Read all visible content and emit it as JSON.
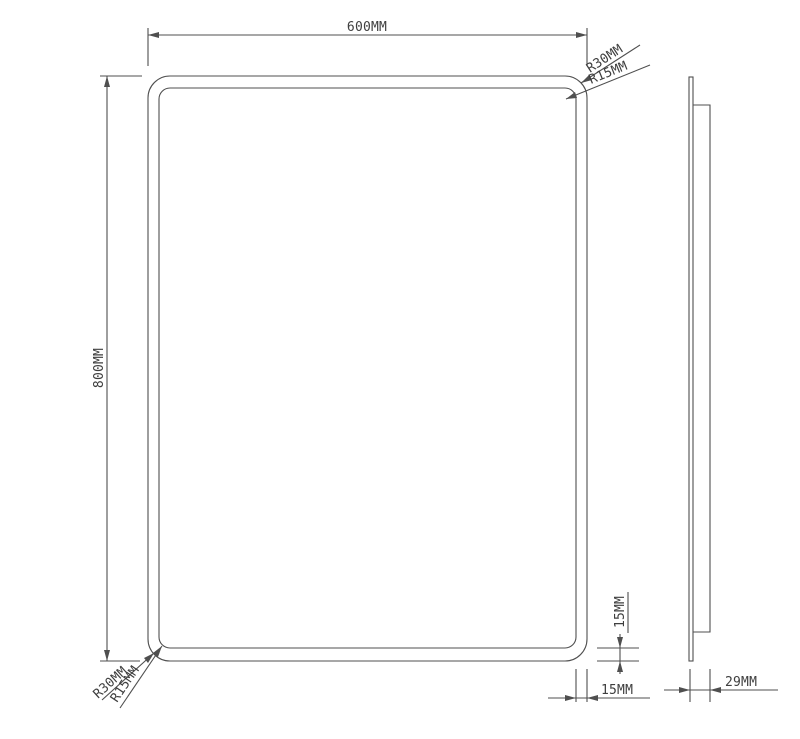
{
  "drawing": {
    "type": "technical-drawing",
    "subject": "rounded-rectangle mirror, front and side elevation",
    "colors": {
      "line": "#4f4f4f",
      "text": "#3e3e3e",
      "background": "#ffffff"
    },
    "front_view": {
      "width_label": "600MM",
      "height_label": "800MM",
      "top_right_outer_radius_label": "R30MM",
      "top_right_inner_radius_label": "R15MM",
      "bottom_left_outer_radius_label": "R30MM",
      "bottom_left_inner_radius_label": "R15MM",
      "frame_gap_vertical_label": "15MM",
      "frame_gap_horizontal_label": "15MM"
    },
    "side_view": {
      "depth_label": "29MM"
    }
  }
}
